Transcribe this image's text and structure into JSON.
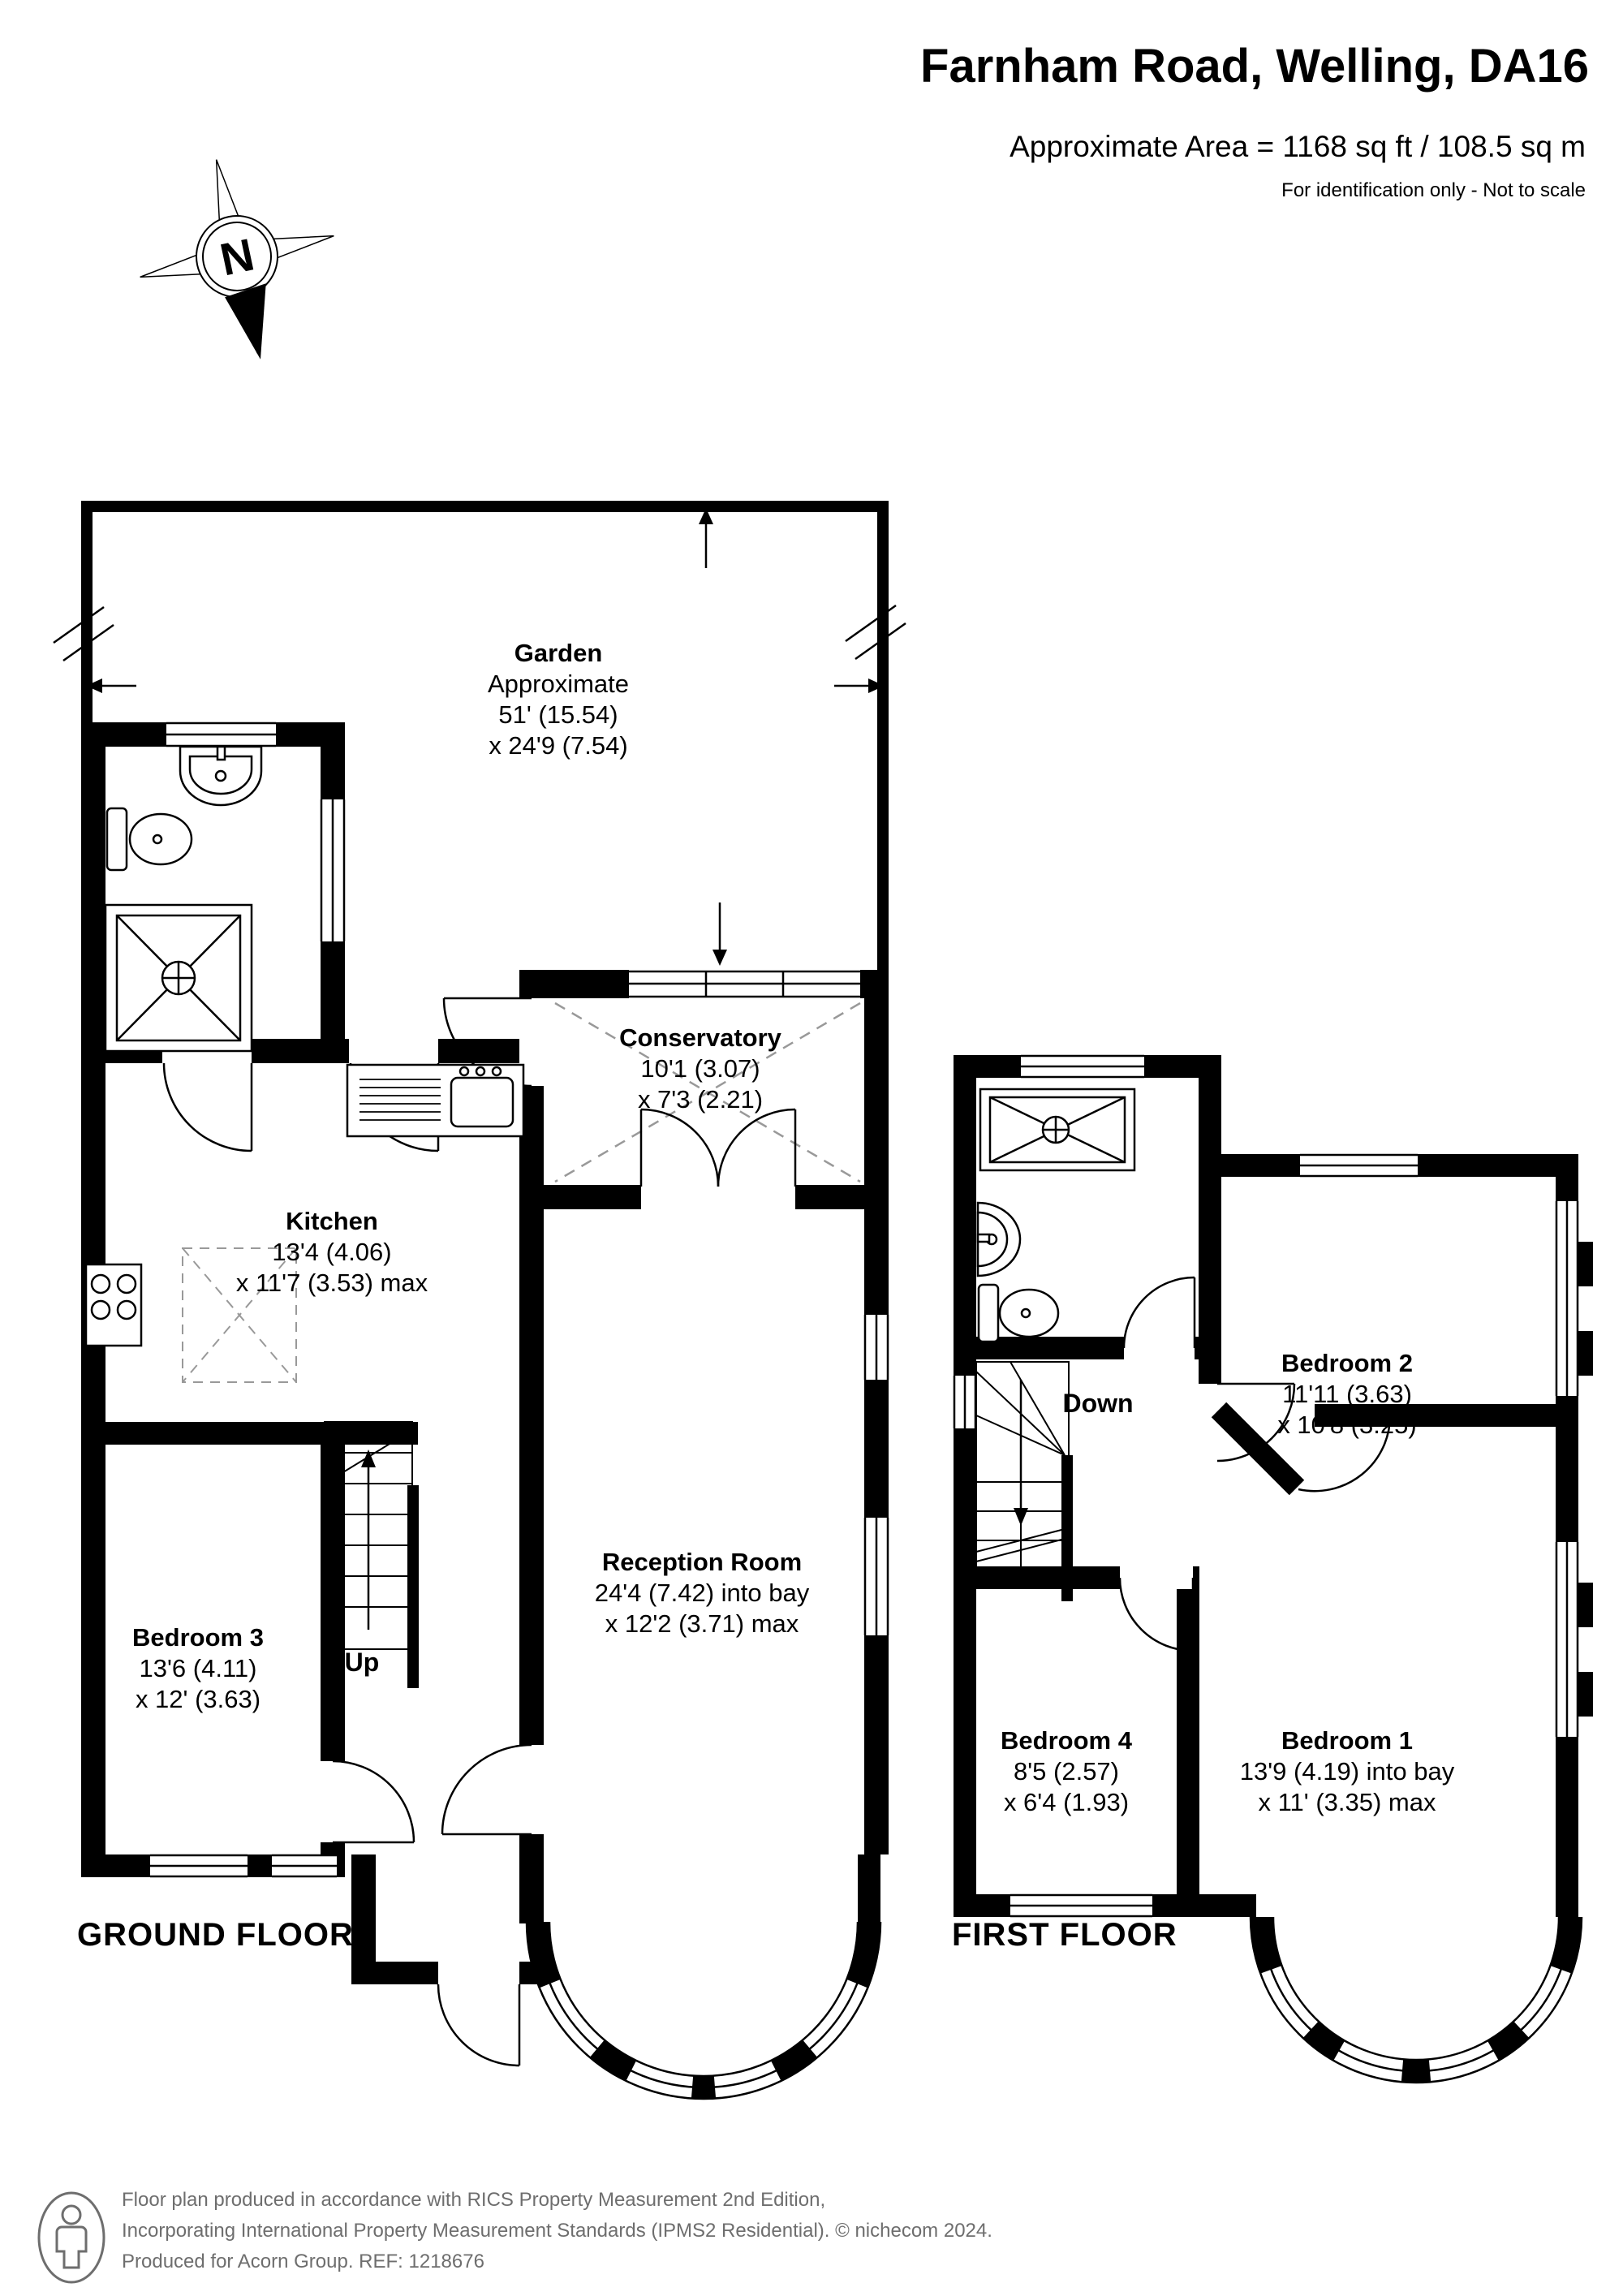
{
  "header": {
    "title": "Farnham Road, Welling, DA16",
    "area": "Approximate Area = 1168 sq ft / 108.5 sq m",
    "note": "For identification only - Not to scale"
  },
  "compass": {
    "label": "N"
  },
  "ground_floor": {
    "floor_label": "GROUND FLOOR",
    "stairs_label": "Up",
    "garden": {
      "name": "Garden",
      "line2": "Approximate",
      "line3": "51' (15.54)",
      "line4": "x 24'9 (7.54)"
    },
    "conservatory": {
      "name": "Conservatory",
      "dims1": "10'1 (3.07)",
      "dims2": "x 7'3 (2.21)"
    },
    "kitchen": {
      "name": "Kitchen",
      "dims1": "13'4 (4.06)",
      "dims2": "x 11'7 (3.53) max"
    },
    "reception": {
      "name": "Reception Room",
      "dims1": "24'4 (7.42) into bay",
      "dims2": "x 12'2 (3.71) max"
    },
    "bedroom3": {
      "name": "Bedroom 3",
      "dims1": "13'6 (4.11)",
      "dims2": "x 12' (3.63)"
    }
  },
  "first_floor": {
    "floor_label": "FIRST FLOOR",
    "stairs_label": "Down",
    "bedroom1": {
      "name": "Bedroom 1",
      "dims1": "13'9 (4.19) into bay",
      "dims2": "x 11' (3.35) max"
    },
    "bedroom2": {
      "name": "Bedroom 2",
      "dims1": "11'11 (3.63)",
      "dims2": "x 10'8 (3.25)"
    },
    "bedroom4": {
      "name": "Bedroom 4",
      "dims1": "8'5 (2.57)",
      "dims2": "x 6'4 (1.93)"
    }
  },
  "footer": {
    "line1": "Floor plan produced in accordance with RICS Property Measurement 2nd Edition,",
    "line2": "Incorporating International Property Measurement Standards (IPMS2 Residential).   © nichecom 2024.",
    "line3": "Produced for Acorn Group.   REF: 1218676"
  },
  "colors": {
    "wall": "#000000",
    "roof_dash": "#999999",
    "footer_text": "#6e6e6e"
  }
}
